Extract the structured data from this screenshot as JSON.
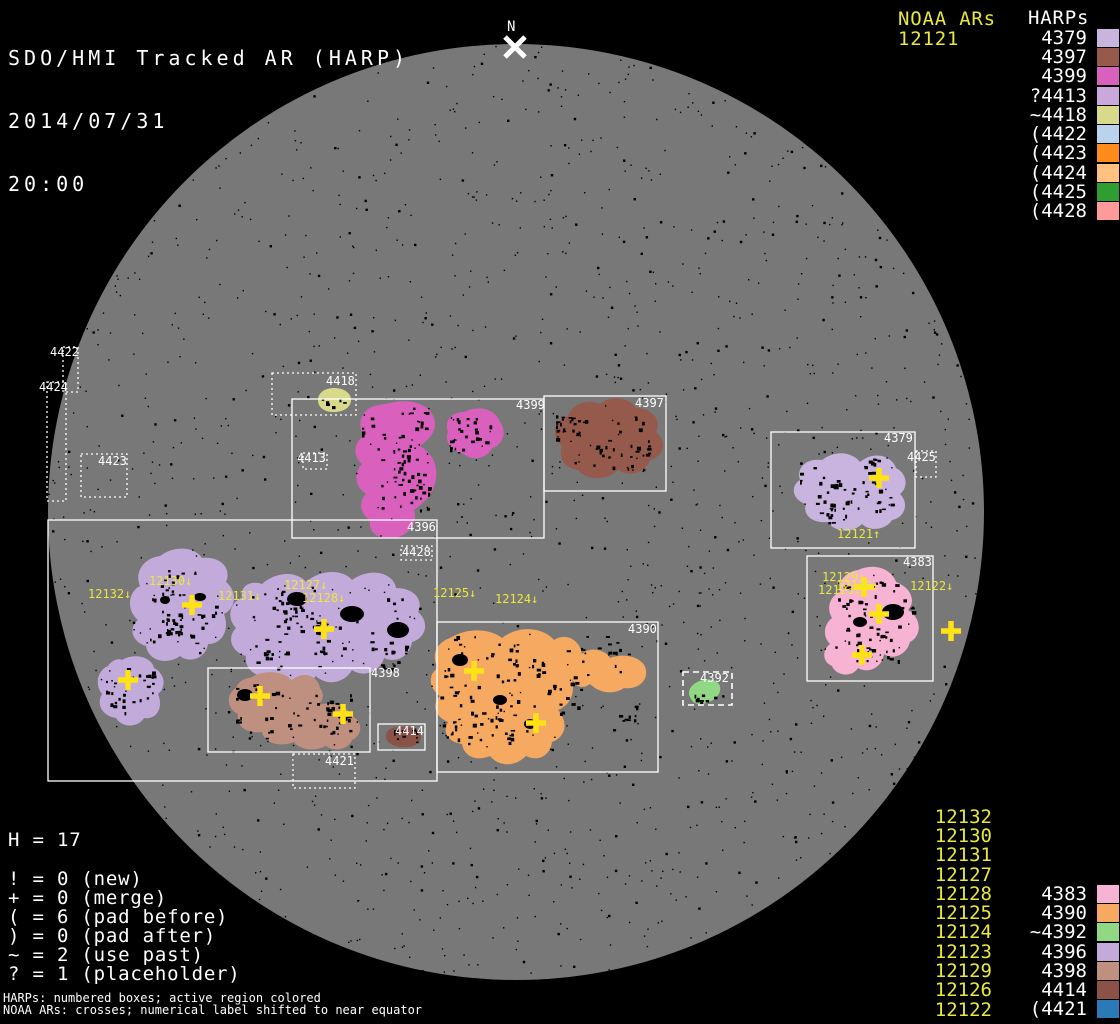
{
  "header": {
    "title": "SDO/HMI Tracked AR (HARP)",
    "date": "2014/07/31",
    "time": "20:00"
  },
  "north_marker": {
    "label": "N"
  },
  "legend_top_right": {
    "noaa_title": "NOAA ARs",
    "noaa_value": "12121",
    "harps_title": "HARPs",
    "items": [
      {
        "label": "4379",
        "harp": "4379"
      },
      {
        "label": "4397",
        "harp": "4397"
      },
      {
        "label": "4399",
        "harp": "4399"
      },
      {
        "label": "?4413",
        "harp": "4413"
      },
      {
        "label": "~4418",
        "harp": "4418"
      },
      {
        "label": "(4422",
        "harp": "4422"
      },
      {
        "label": "(4423",
        "harp": "4423"
      },
      {
        "label": "(4424",
        "harp": "4424"
      },
      {
        "label": "(4425",
        "harp": "4425"
      },
      {
        "label": "(4428",
        "harp": "4428"
      }
    ]
  },
  "legend_bottom_left": {
    "h_line": "H = 17",
    "stats": [
      "! = 0 (new)",
      "+ = 0 (merge)",
      "( = 6 (pad before)",
      ") = 0 (pad after)",
      "~ = 2 (use past)",
      "? = 1 (placeholder)"
    ],
    "footnote1": "HARPs: numbered boxes; active region colored",
    "footnote2": "NOAA ARs: crosses; numerical label shifted to near equator"
  },
  "legend_bottom_right": {
    "noaa_items": [
      "12132",
      "12130",
      "12131",
      "12127",
      "12128",
      "12125",
      "12124",
      "12123",
      "12129",
      "12126",
      "12122"
    ],
    "harp_items": [
      {
        "label": "4383",
        "harp": "4383"
      },
      {
        "label": "4390",
        "harp": "4390"
      },
      {
        "label": "~4392",
        "harp": "4392"
      },
      {
        "label": "4396",
        "harp": "4396"
      },
      {
        "label": "4398",
        "harp": "4398"
      },
      {
        "label": "4414",
        "harp": "4414"
      },
      {
        "label": "(4421",
        "harp": "4421"
      }
    ]
  },
  "harp_boxes": [
    {
      "label": "4422"
    },
    {
      "label": "4424"
    },
    {
      "label": "4423"
    },
    {
      "label": "4418"
    },
    {
      "label": "4413"
    },
    {
      "label": "4428"
    },
    {
      "label": "4421"
    },
    {
      "label": "4425"
    },
    {
      "label": "4392"
    },
    {
      "label": "4399"
    },
    {
      "label": "4397"
    },
    {
      "label": "4396"
    },
    {
      "label": "4390"
    },
    {
      "label": "4379"
    },
    {
      "label": "4383"
    },
    {
      "label": "4398"
    },
    {
      "label": "4414"
    }
  ],
  "noaa_marks": [
    {
      "label": "12132↓"
    },
    {
      "label": "12130↓"
    },
    {
      "label": "12131↓"
    },
    {
      "label": "12127↓"
    },
    {
      "label": "12128↓"
    },
    {
      "label": "12125↓"
    },
    {
      "label": "12124↓"
    },
    {
      "label": "12121↑"
    },
    {
      "label": "12129↓"
    },
    {
      "label": "12126↓"
    },
    {
      "label": "12123↓"
    },
    {
      "label": "12122↓"
    }
  ],
  "colors": {
    "background": "#000000",
    "disk": "#787878",
    "text_white": "#ffffff",
    "text_yellow": "#e9e83b",
    "cross_yellow": "#ffe215",
    "regions": {
      "4379": "#c9b4df",
      "4383": "#f6b3d3",
      "4390": "#f5a961",
      "4392": "#90d883",
      "4396": "#c2abdb",
      "4397": "#965a4d",
      "4398": "#bf8f7f",
      "4399": "#d960bd",
      "4413": "#c9a9dc",
      "4414": "#8b5348",
      "4418": "#d8d98a",
      "4421": "#2a7ab8",
      "4422": "#b9d2ee",
      "4423": "#ff8c1a",
      "4424": "#ffc080",
      "4425": "#2f9e30",
      "4428": "#ff9a9a"
    }
  },
  "chart_data": {
    "type": "table",
    "title": "SDO/HMI Tracked AR (HARP) 2014/07/31 20:00",
    "harp_total": 17,
    "symbol_counts": {
      "new": 0,
      "merge": 0,
      "pad_before": 6,
      "pad_after": 0,
      "use_past": 2,
      "placeholder": 1
    },
    "harps_near_limb_east": [
      "4379",
      "4397",
      "4399",
      "?4413",
      "~4418",
      "(4422",
      "(4423",
      "(4424",
      "(4425",
      "(4428"
    ],
    "harps_near_limb_west": [
      "4383",
      "4390",
      "~4392",
      "4396",
      "4398",
      "4414",
      "(4421"
    ],
    "noaa_active_regions": [
      "12121",
      "12132",
      "12130",
      "12131",
      "12127",
      "12128",
      "12125",
      "12124",
      "12123",
      "12129",
      "12126",
      "12122"
    ]
  }
}
